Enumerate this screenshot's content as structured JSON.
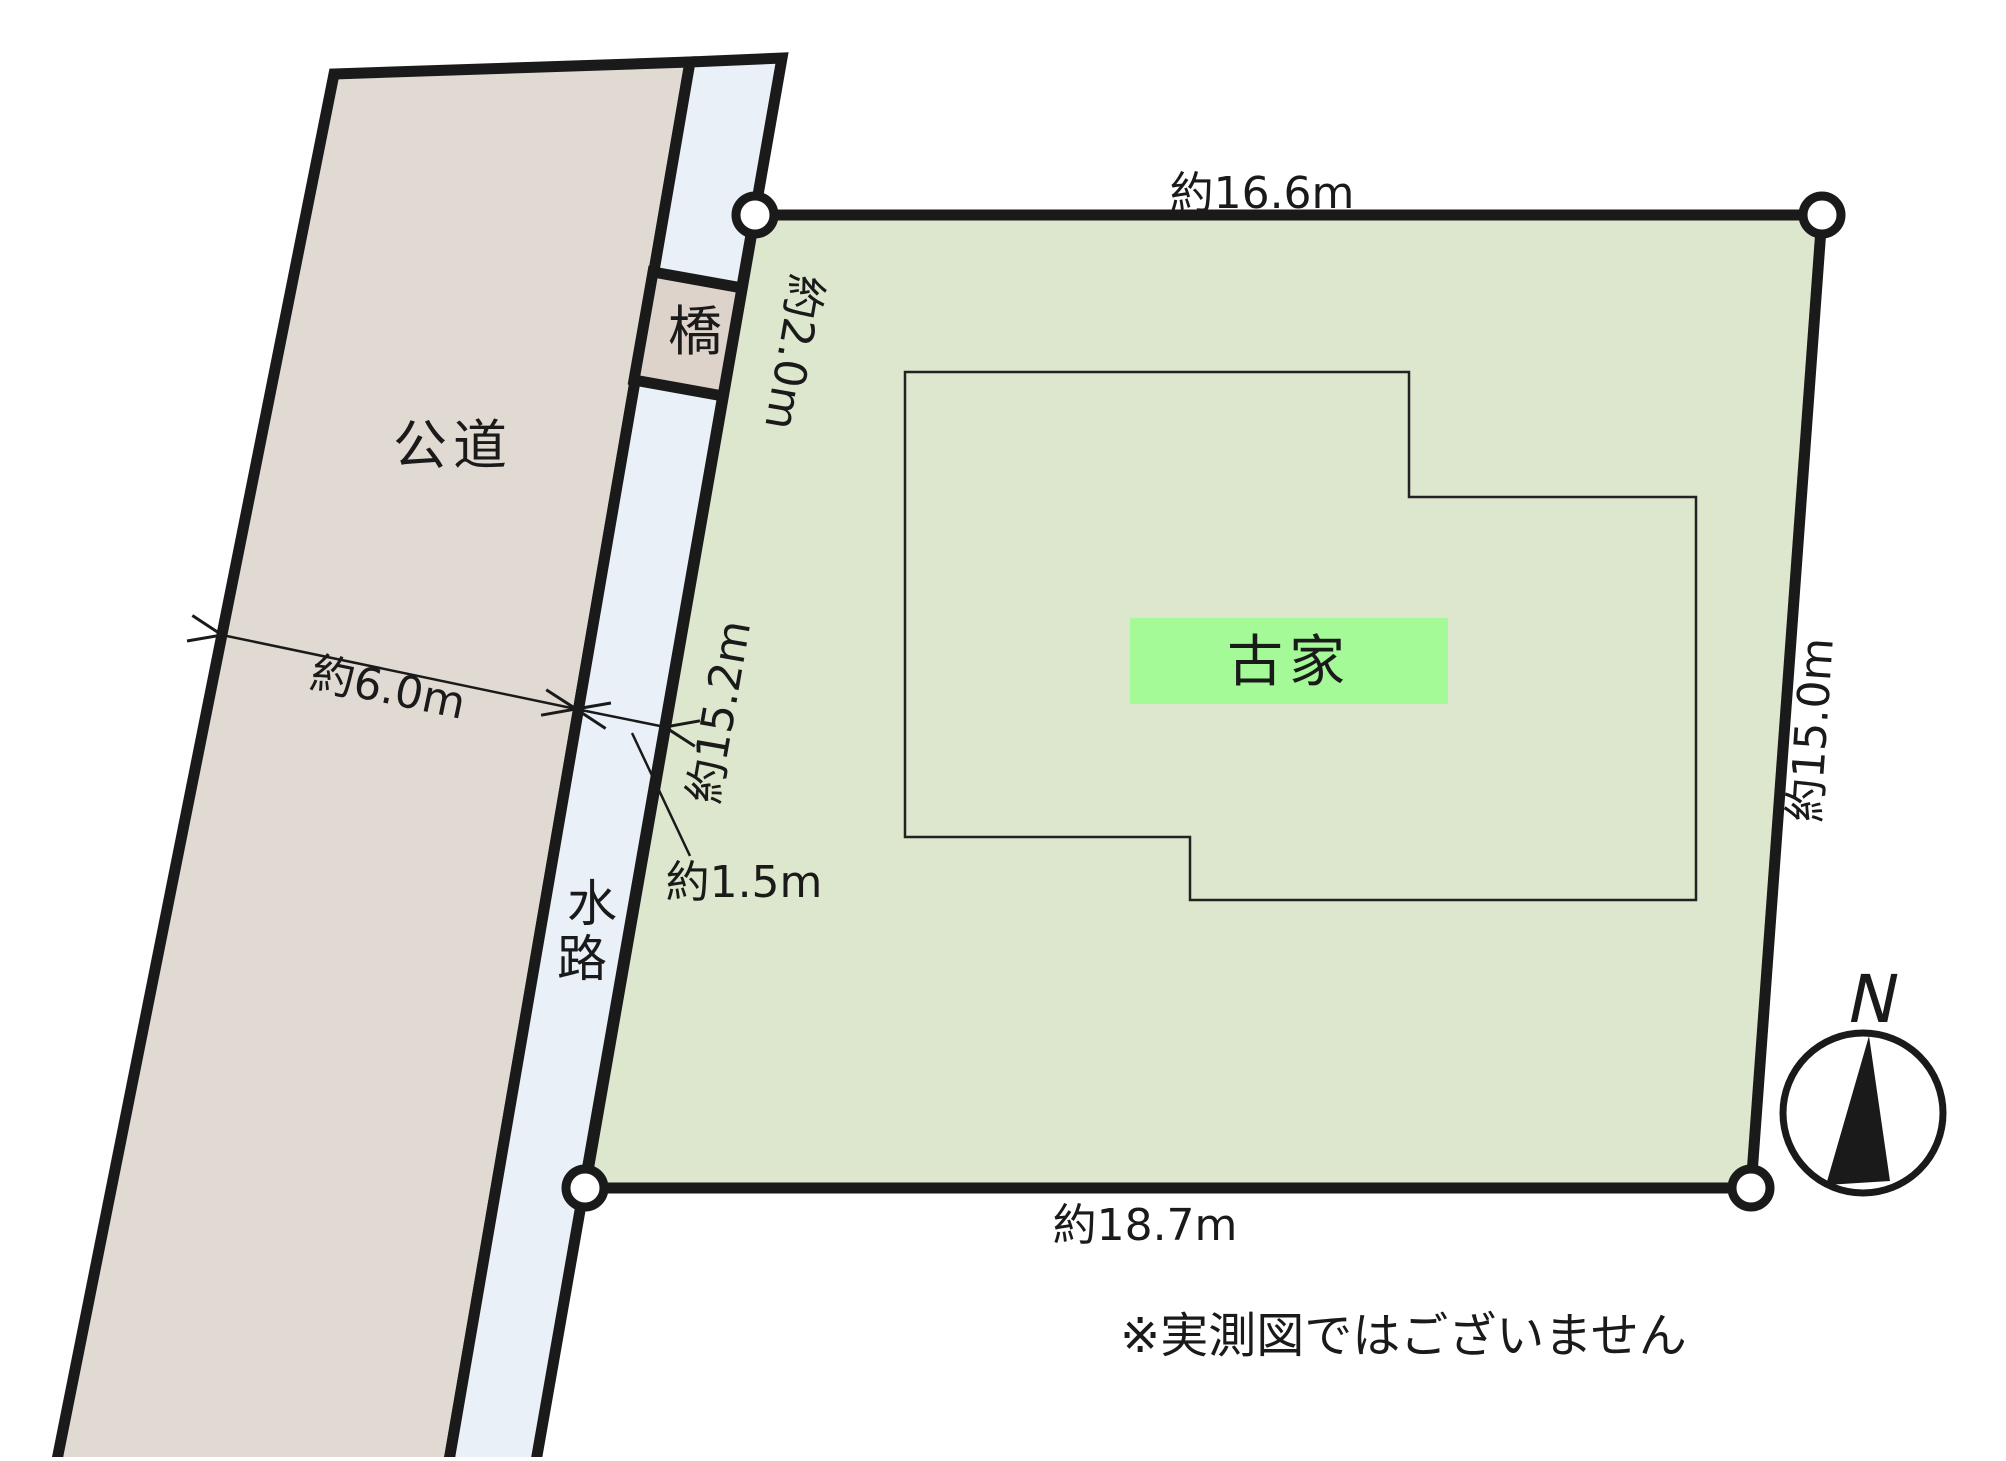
{
  "page": {
    "note": "※実測図ではございません"
  },
  "compass": {
    "north_label": "N"
  },
  "road": {
    "label": "公道",
    "width_dimension": "約6.0m"
  },
  "waterway": {
    "label": "水路",
    "char1": "水",
    "char2": "路",
    "width_dimension": "約1.5m"
  },
  "bridge": {
    "label": "橋"
  },
  "plot": {
    "top_dimension": "約16.6m",
    "upper_left_dimension": "約2.0m",
    "left_dimension": "約15.2m",
    "right_dimension": "約15.0m",
    "bottom_dimension": "約18.7m"
  },
  "house": {
    "label": "古家"
  },
  "colors": {
    "road_fill": "#e0dad2",
    "bridge_fill": "#ded3cb",
    "waterway_fill": "#e9f0f8",
    "plot_fill": "#dde7cd",
    "house_label_bg": "#a3fa97",
    "line": "#1a1a1a"
  }
}
